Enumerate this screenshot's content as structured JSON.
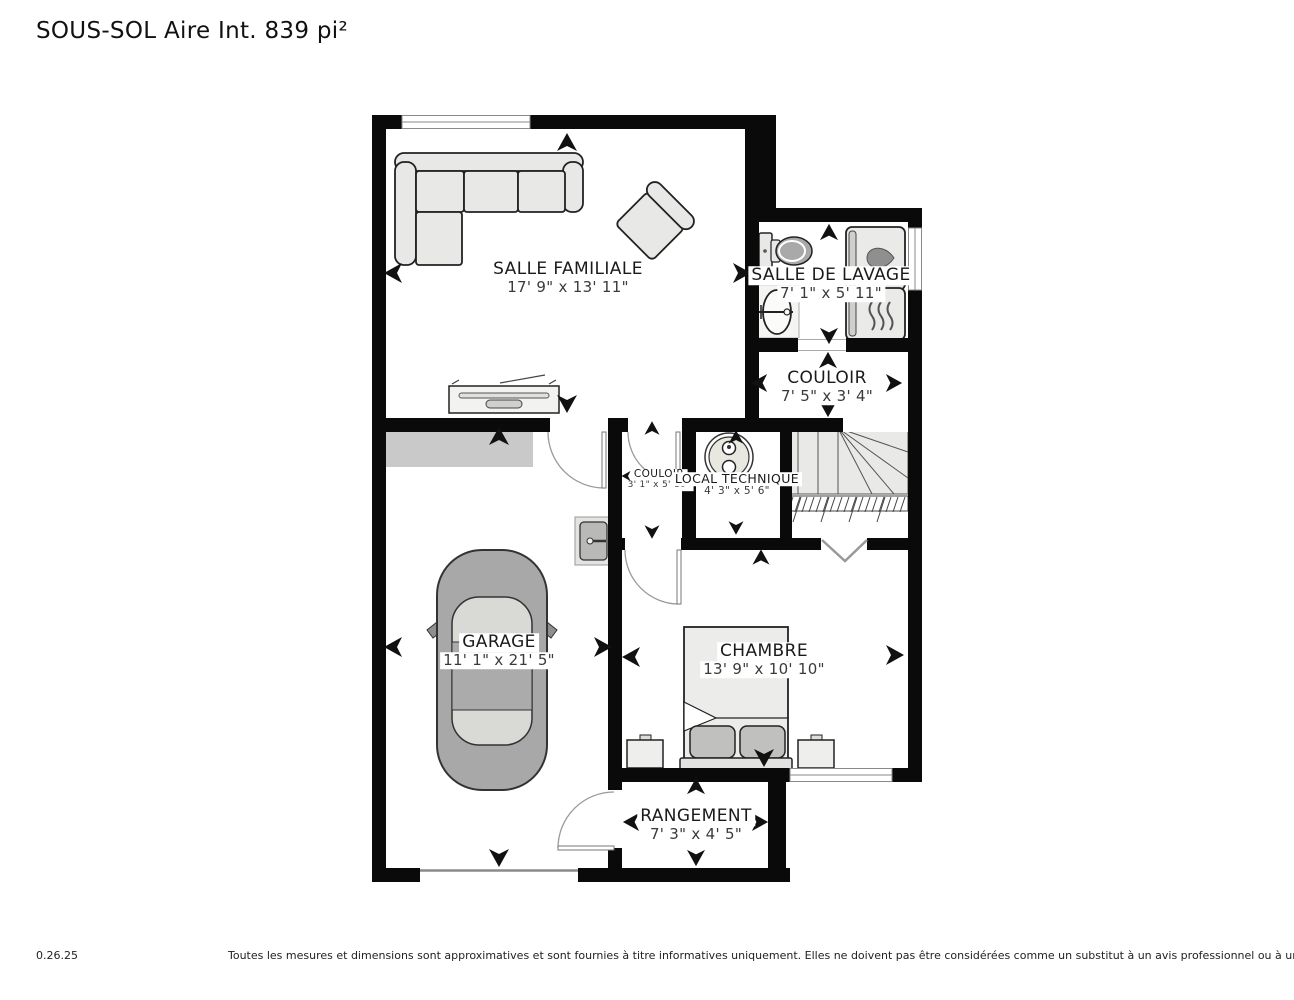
{
  "title": "SOUS-SOL Aire Int. 839 pi²",
  "rooms": [
    {
      "name": "SALLE FAMILIALE",
      "dims": "17' 9\" x 13' 11\""
    },
    {
      "name": "SALLE DE LAVAGE",
      "dims": "7' 1\" x 5' 11\""
    },
    {
      "name": "COULOIR",
      "dims": "7' 5\" x 3' 4\""
    },
    {
      "name": "COULOIR",
      "dims": "3' 1\" x 5' 10\""
    },
    {
      "name": "LOCAL TECHNIQUE",
      "dims": "4' 3\" x 5' 6\""
    },
    {
      "name": "GARAGE",
      "dims": "11' 1\" x 21' 5\""
    },
    {
      "name": "CHAMBRE",
      "dims": "13' 9\" x 10' 10\""
    },
    {
      "name": "RANGEMENT",
      "dims": "7' 3\" x 4' 5\""
    }
  ],
  "footer": {
    "version": "0.26.25",
    "disclaimer": "Toutes les mesures et dimensions sont approximatives et sont fournies à titre informatives uniquement. Elles ne doivent pas être considérées comme un substitut à un avis professionnel ou à une évaluation précise."
  },
  "colors": {
    "wall": "#0a0a0a",
    "room_fill": "#ffffff",
    "furniture_fill": "#e8e8e6",
    "car_fill": "#a8a8a8",
    "shelf_gray": "#c9c9c9",
    "stairs_fill": "#e9e9e7"
  }
}
